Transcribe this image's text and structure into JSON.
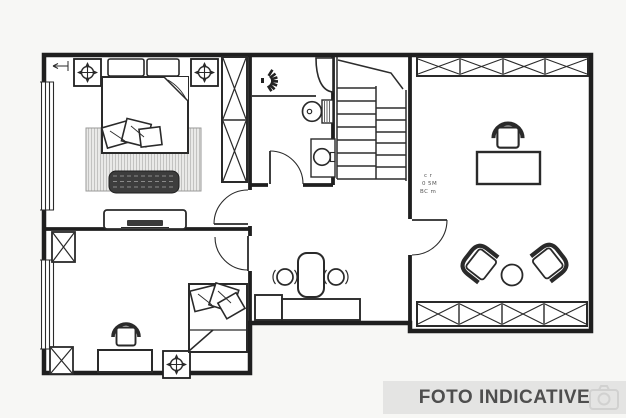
{
  "page": {
    "background": "#f7f7f5"
  },
  "banner": {
    "label": "FOTO INDICATIVE",
    "bg_color": "#e4e4e3",
    "text_color": "#4e4e4e",
    "watermark_icon": "camera-icon"
  },
  "plan": {
    "type": "floor-plan",
    "floor_color": "#ffffff",
    "wall_color": "#1f1f1f",
    "furniture_color": "#2a2a2a",
    "note_lines": {
      "0": "c r",
      "1": "0 5M",
      "2": "BC m"
    },
    "rooms": [
      {
        "id": "bedroom-top-left",
        "elements": [
          "ceiling-light-symbol",
          "ceiling-light-symbol",
          "pillows",
          "double-bed",
          "cushions",
          "area-rug",
          "storage-bench",
          "wardrobe-2-door",
          "dresser-with-tv",
          "window"
        ]
      },
      {
        "id": "bathroom",
        "elements": [
          "shower",
          "shower-spray-icon",
          "toilet",
          "washbasin",
          "door"
        ]
      },
      {
        "id": "staircase",
        "elements": [
          "stair-run-left",
          "stair-run-right"
        ]
      },
      {
        "id": "hallway",
        "elements": [
          "console-desk",
          "high-back-chair",
          "stool",
          "stool",
          "door-to-bedroom-top",
          "door-to-bedroom-bottom"
        ]
      },
      {
        "id": "bedroom-bottom-left",
        "elements": [
          "wardrobe",
          "wardrobe",
          "desk",
          "office-chair",
          "single-bed",
          "cushions",
          "ceiling-light-symbol",
          "window"
        ]
      },
      {
        "id": "studio-right",
        "elements": [
          "wardrobe-4-door-top",
          "desk",
          "office-chair",
          "armchair",
          "armchair",
          "round-table",
          "wardrobe-4-door-bottom",
          "entry-door",
          "dimension-note"
        ]
      }
    ]
  }
}
